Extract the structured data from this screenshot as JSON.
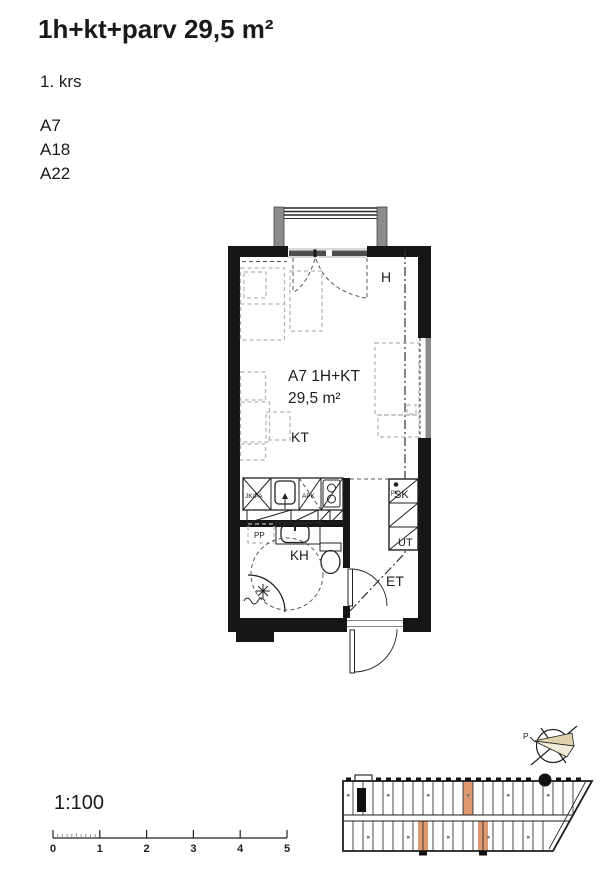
{
  "header": {
    "title": "1h+kt+parv 29,5 m²",
    "floor": "1. krs",
    "unit_ids": [
      "A7",
      "A18",
      "A22"
    ]
  },
  "plan": {
    "hall_label": "H",
    "apartment_id": "A7 1H+KT",
    "area": "29,5 m²",
    "kitchen_label": "KT",
    "bathroom_label": "KH",
    "entry_label": "ET",
    "closet_top_label": "SK",
    "closet_bottom_label": "UT",
    "fridge_label": "JK/PA",
    "dishwasher_label": "APK",
    "washer_space_label": "PP",
    "water_point_label": "pv"
  },
  "scale": {
    "ratio": "1:100",
    "tick_labels": [
      "0",
      "1",
      "2",
      "3",
      "4",
      "5"
    ]
  },
  "site_plan": {
    "north_label": "P",
    "highlight_color": "#dd9a70",
    "highlighted_units_count": "3"
  },
  "colors": {
    "wall": "#161616",
    "furniture_dash": "#b3b3b3",
    "balcony_post": "#8c8c8c",
    "window_glass": "#4d4d4d",
    "compass_fan": "#ddd2ac"
  }
}
